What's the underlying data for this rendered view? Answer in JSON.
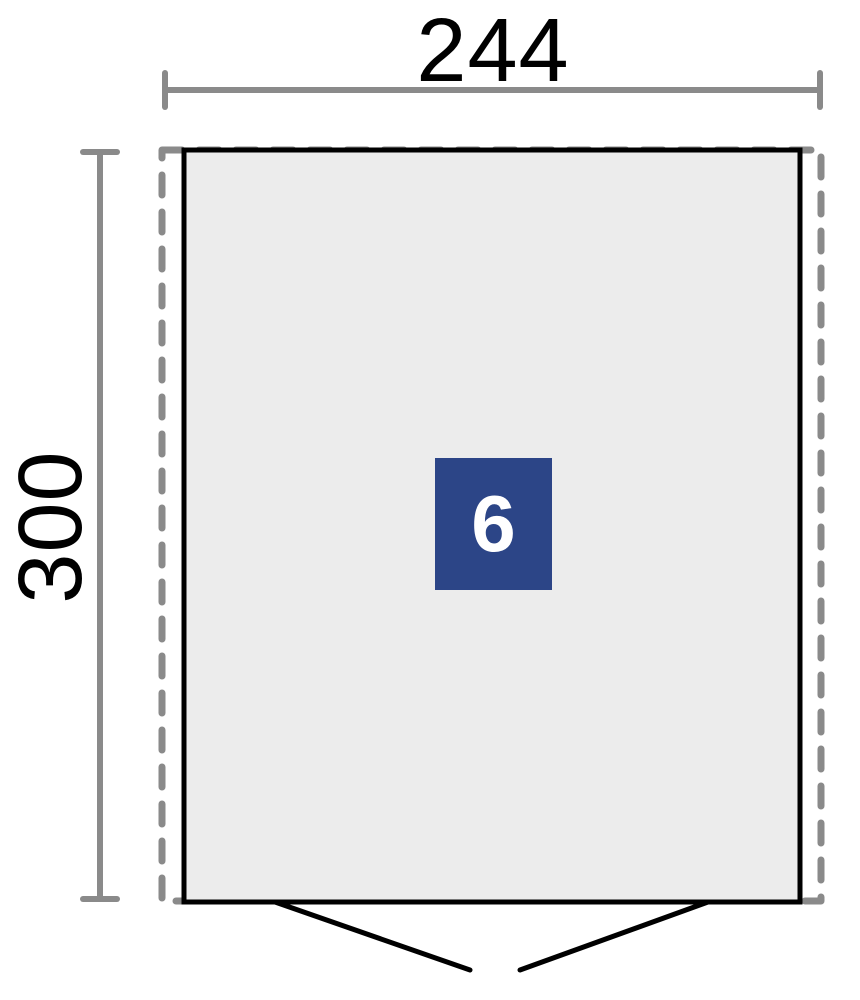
{
  "figure": {
    "type": "shed-floor-plan",
    "width_dimension_label": "244",
    "height_dimension_label": "300",
    "area_badge_label": "6"
  },
  "colors": {
    "background": "#ffffff",
    "dimension_line": "#8a8a8a",
    "dashed_outline": "#8a8a8a",
    "wall_outline": "#000000",
    "floor_fill": "#ececec",
    "door_line": "#000000",
    "badge_background": "#2c4587",
    "badge_text": "#ffffff",
    "dimension_text": "#000000"
  }
}
